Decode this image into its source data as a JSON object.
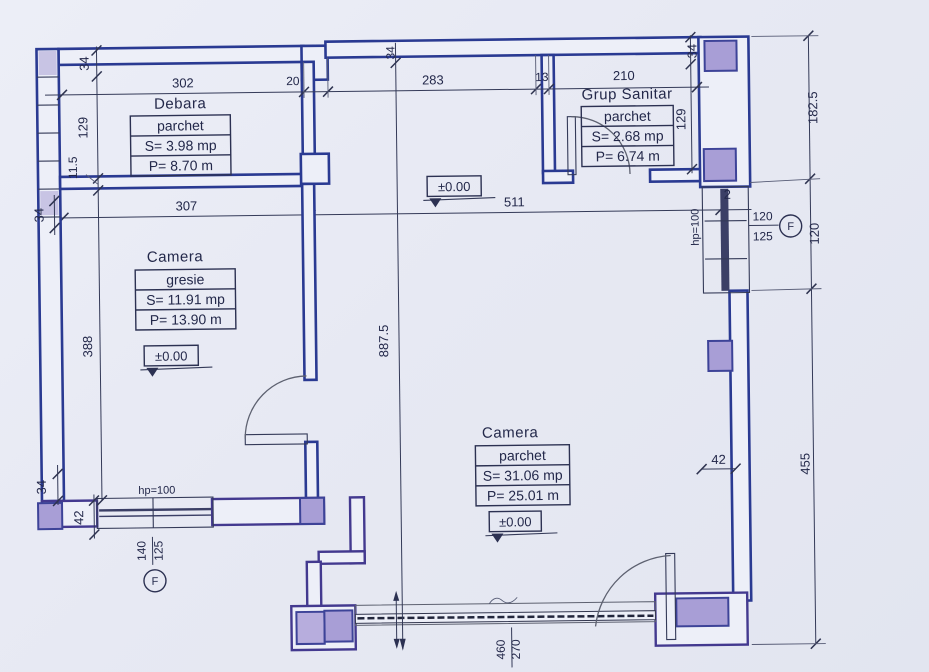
{
  "plan": {
    "level": "±0.00",
    "rooms": [
      {
        "name": "Debara",
        "finish": "parchet",
        "area": "S= 3.98 mp",
        "perimeter": "P= 8.70 m"
      },
      {
        "name": "Grup Sanitar",
        "finish": "parchet",
        "area": "S= 2.68 mp",
        "perimeter": "P= 6.74 m"
      },
      {
        "name": "Camera",
        "finish": "gresie",
        "area": "S= 11.91 mp",
        "perimeter": "P= 13.90 m"
      },
      {
        "name": "Camera",
        "finish": "parchet",
        "area": "S= 31.06 mp",
        "perimeter": "P= 25.01 m"
      }
    ],
    "dims": {
      "d302": "302",
      "d20": "20",
      "d283": "283",
      "d13": "13",
      "d210": "210",
      "d307": "307",
      "d511": "511",
      "d34": "34",
      "d129": "129",
      "d115": "11.5",
      "d388": "388",
      "d42": "42",
      "d2": "2",
      "d1825": "182.5",
      "d120": "120",
      "d455": "455",
      "d8875": "887.5",
      "d460": "460",
      "d270": "270"
    },
    "windows": {
      "left": {
        "hp": "hp=100",
        "w": "140",
        "h": "125",
        "sym": "F"
      },
      "right": {
        "hp": "hp=100",
        "w": "120",
        "h": "125",
        "sym": "F"
      }
    },
    "colors": {
      "ink": "#2a3a92",
      "column": "#a89ed6",
      "paper": "#e7e9f2",
      "dimline": "#343a58"
    }
  }
}
